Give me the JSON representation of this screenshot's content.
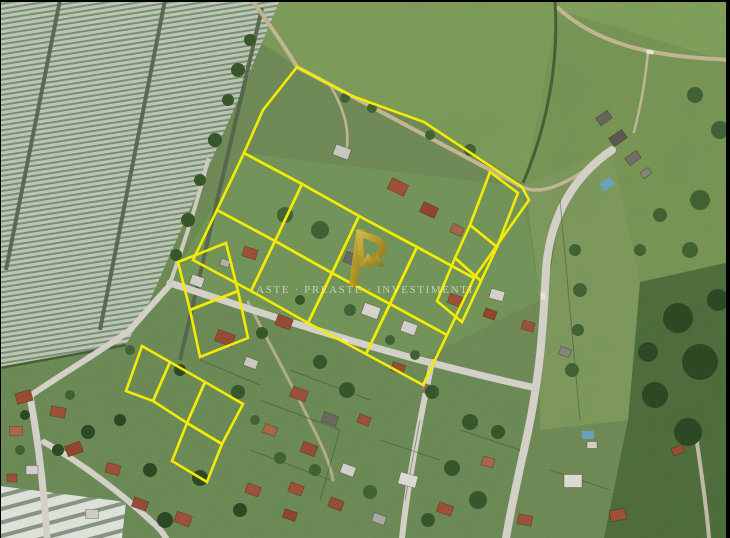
{
  "page": {
    "type": "aerial-photo-listing",
    "description": "Satellite aerial photograph of a semi-rural area: striped greenhouse field on the left, green farm fields on top and right, a residential subdivision with terracotta-roof houses in the middle, and a group of land parcels outlined in yellow."
  },
  "watermark": {
    "text": "ASTE · PREASTE · INVESTIMENTI",
    "logo_icon": "gold-monogram-logo"
  },
  "overlay": {
    "parcel_outline_color": "#f3eb02",
    "parcel_count": 18
  },
  "frame": {
    "border_color": "#000000"
  },
  "scene_colors": {
    "field_green": "#74905a",
    "greenhouse_light": "#c2cdba",
    "road_grey": "#dbd8cf",
    "dirt_tan": "#c9bc97",
    "roof_terracotta": "#a0543a",
    "logo_gold": "#c9a22c"
  }
}
